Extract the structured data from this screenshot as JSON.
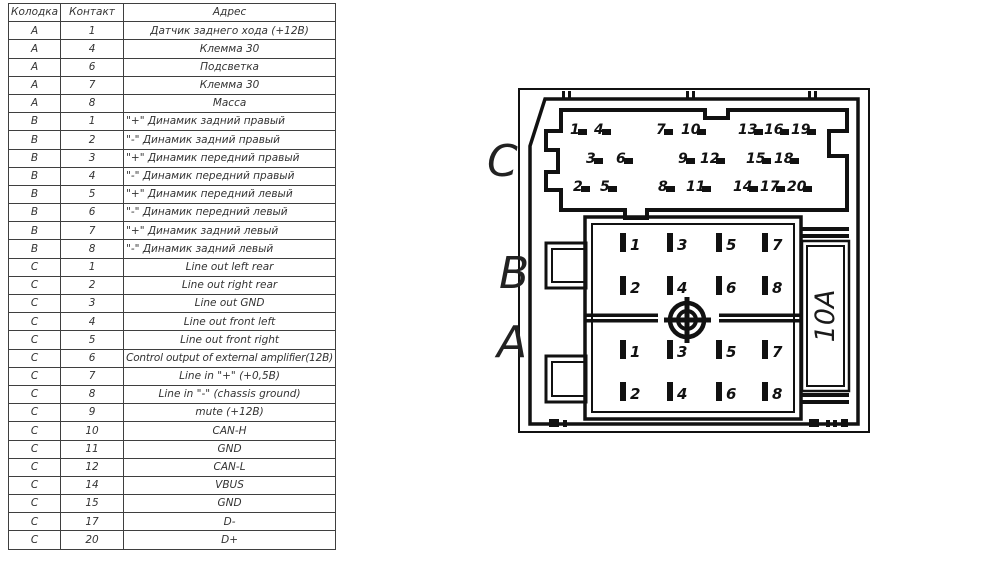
{
  "table": {
    "headers": [
      "Колодка",
      "Контакт",
      "Адрес"
    ],
    "rows": [
      [
        "A",
        "1",
        "Датчик заднего хода (+12В)"
      ],
      [
        "A",
        "4",
        "Клемма 30"
      ],
      [
        "A",
        "6",
        "Подсветка"
      ],
      [
        "A",
        "7",
        "Клемма 30"
      ],
      [
        "A",
        "8",
        "Масса"
      ],
      [
        "B",
        "1",
        "\"+\" Динамик задний правый"
      ],
      [
        "B",
        "2",
        "\"-\" Динамик задний правый"
      ],
      [
        "B",
        "3",
        "\"+\" Динамик передний правый"
      ],
      [
        "B",
        "4",
        "\"-\" Динамик передний правый"
      ],
      [
        "B",
        "5",
        "\"+\" Динамик передний левый"
      ],
      [
        "B",
        "6",
        "\"-\" Динамик передний левый"
      ],
      [
        "B",
        "7",
        "\"+\" Динамик задний левый"
      ],
      [
        "B",
        "8",
        "\"-\" Динамик задний левый"
      ],
      [
        "C",
        "1",
        "Line out left rear"
      ],
      [
        "C",
        "2",
        "Line out right rear"
      ],
      [
        "C",
        "3",
        "Line out GND"
      ],
      [
        "C",
        "4",
        "Line out front left"
      ],
      [
        "C",
        "5",
        "Line out front right"
      ],
      [
        "C",
        "6",
        "Control output of external amplifier(12В)"
      ],
      [
        "C",
        "7",
        "Line in \"+\" (+0,5В)"
      ],
      [
        "C",
        "8",
        "Line in \"-\" (chassis ground)"
      ],
      [
        "C",
        "9",
        "mute (+12В)"
      ],
      [
        "C",
        "10",
        "CAN-H"
      ],
      [
        "C",
        "11",
        "GND"
      ],
      [
        "C",
        "12",
        "CAN-L"
      ],
      [
        "C",
        "14",
        "VBUS"
      ],
      [
        "C",
        "15",
        "GND"
      ],
      [
        "C",
        "17",
        "D-"
      ],
      [
        "C",
        "20",
        "D+"
      ]
    ]
  },
  "connector": {
    "section_labels": [
      "C",
      "B",
      "A"
    ],
    "fuse_label": "10A",
    "c_rows": [
      [
        "1",
        "4",
        "7",
        "10",
        "13",
        "16",
        "19"
      ],
      [
        "3",
        "6",
        "9",
        "12",
        "15",
        "18"
      ],
      [
        "2",
        "5",
        "8",
        "11",
        "14",
        "17",
        "20"
      ]
    ],
    "b_pins": [
      [
        "1",
        "3",
        "5",
        "7"
      ],
      [
        "2",
        "4",
        "6",
        "8"
      ]
    ],
    "a_pins": [
      [
        "1",
        "3",
        "5",
        "7"
      ],
      [
        "2",
        "4",
        "6",
        "8"
      ]
    ],
    "line_color": "#111111"
  }
}
